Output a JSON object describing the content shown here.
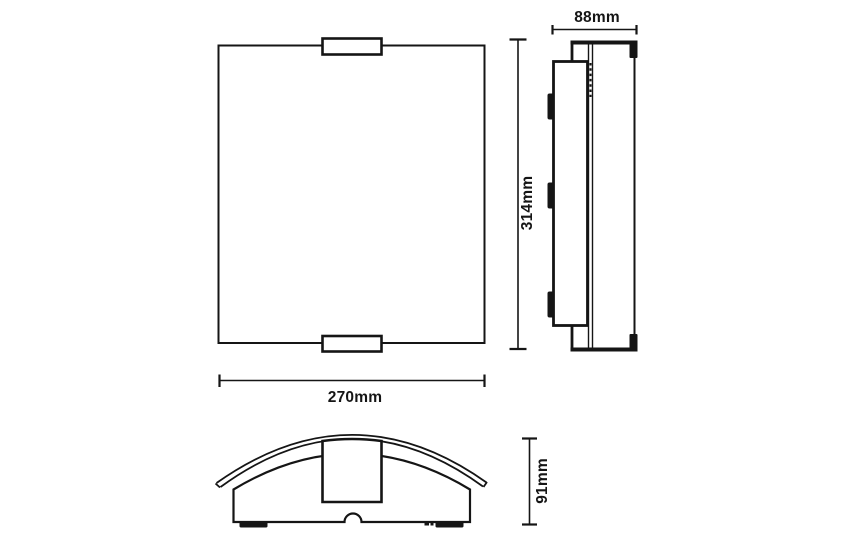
{
  "drawing": {
    "description": "three-view technical dimension drawing of a wall light fixture",
    "views": [
      "front-view",
      "side-view",
      "profile-view"
    ]
  },
  "dimensions": {
    "width": "270mm",
    "height": "314mm",
    "depth": "88mm",
    "profile_height": "91mm"
  },
  "colors": {
    "background": "#ffffff",
    "line": "#151515"
  }
}
